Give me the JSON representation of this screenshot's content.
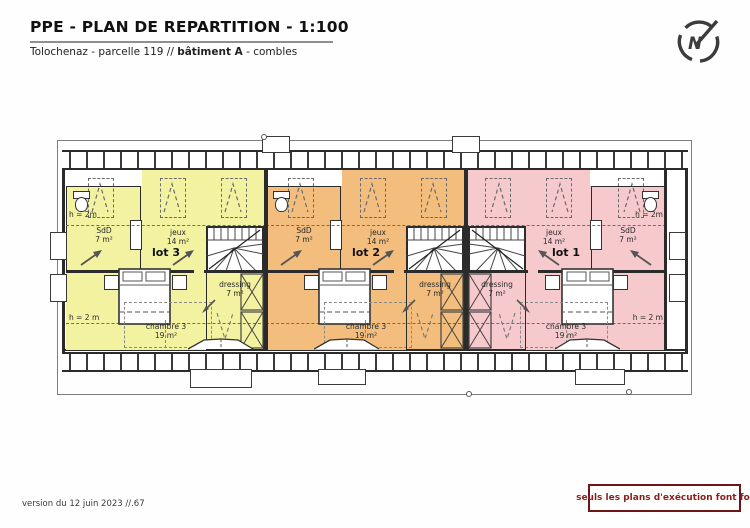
{
  "header": {
    "title": "PPE - PLAN DE REPARTITION - 1:100",
    "subtitle": {
      "prefix": "Tolochenaz - parcelle 119 // ",
      "building": "bâtiment A",
      "suffix": " - combles"
    }
  },
  "compass": {
    "letter": "N"
  },
  "plan": {
    "lots": [
      {
        "label": "lot 3",
        "color": "#f3f2a0",
        "mirrored": false,
        "dormer_x": 122,
        "h_top": "h = 2m",
        "h_bottom": "h = 2 m",
        "rooms": {
          "sdd": {
            "name": "SdD",
            "area": "7 m²"
          },
          "jeux": {
            "name": "jeux",
            "area": "14 m²"
          },
          "chambre": {
            "name": "chambre 3",
            "area": "19 m²"
          },
          "dressing": {
            "name": "dressing",
            "area": "7 m²"
          }
        }
      },
      {
        "label": "lot 2",
        "color": "#f2bd7d",
        "mirrored": false,
        "dormer_x": 48,
        "h_top": "",
        "h_bottom": "",
        "rooms": {
          "sdd": {
            "name": "SdD",
            "area": "7 m²"
          },
          "jeux": {
            "name": "jeux",
            "area": "14 m²"
          },
          "chambre": {
            "name": "chambre 3",
            "area": "19 m²"
          },
          "dressing": {
            "name": "dressing",
            "area": "7 m²"
          }
        }
      },
      {
        "label": "lot 1",
        "color": "#f6c9cc",
        "mirrored": true,
        "dormer_x": 46,
        "h_top": "h = 2m",
        "h_bottom": "h = 2 m",
        "rooms": {
          "sdd": {
            "name": "SdD",
            "area": "7 m²"
          },
          "jeux": {
            "name": "jeux",
            "area": "14 m²"
          },
          "chambre": {
            "name": "chambre 3",
            "area": "19 m²"
          },
          "dressing": {
            "name": "dressing",
            "area": "7 m²"
          }
        }
      }
    ]
  },
  "footer": {
    "version": "version du 12 juin 2023 //.67",
    "notice": "seuls les plans d'exécution font foi",
    "notice_color": "#8a1f1f"
  }
}
